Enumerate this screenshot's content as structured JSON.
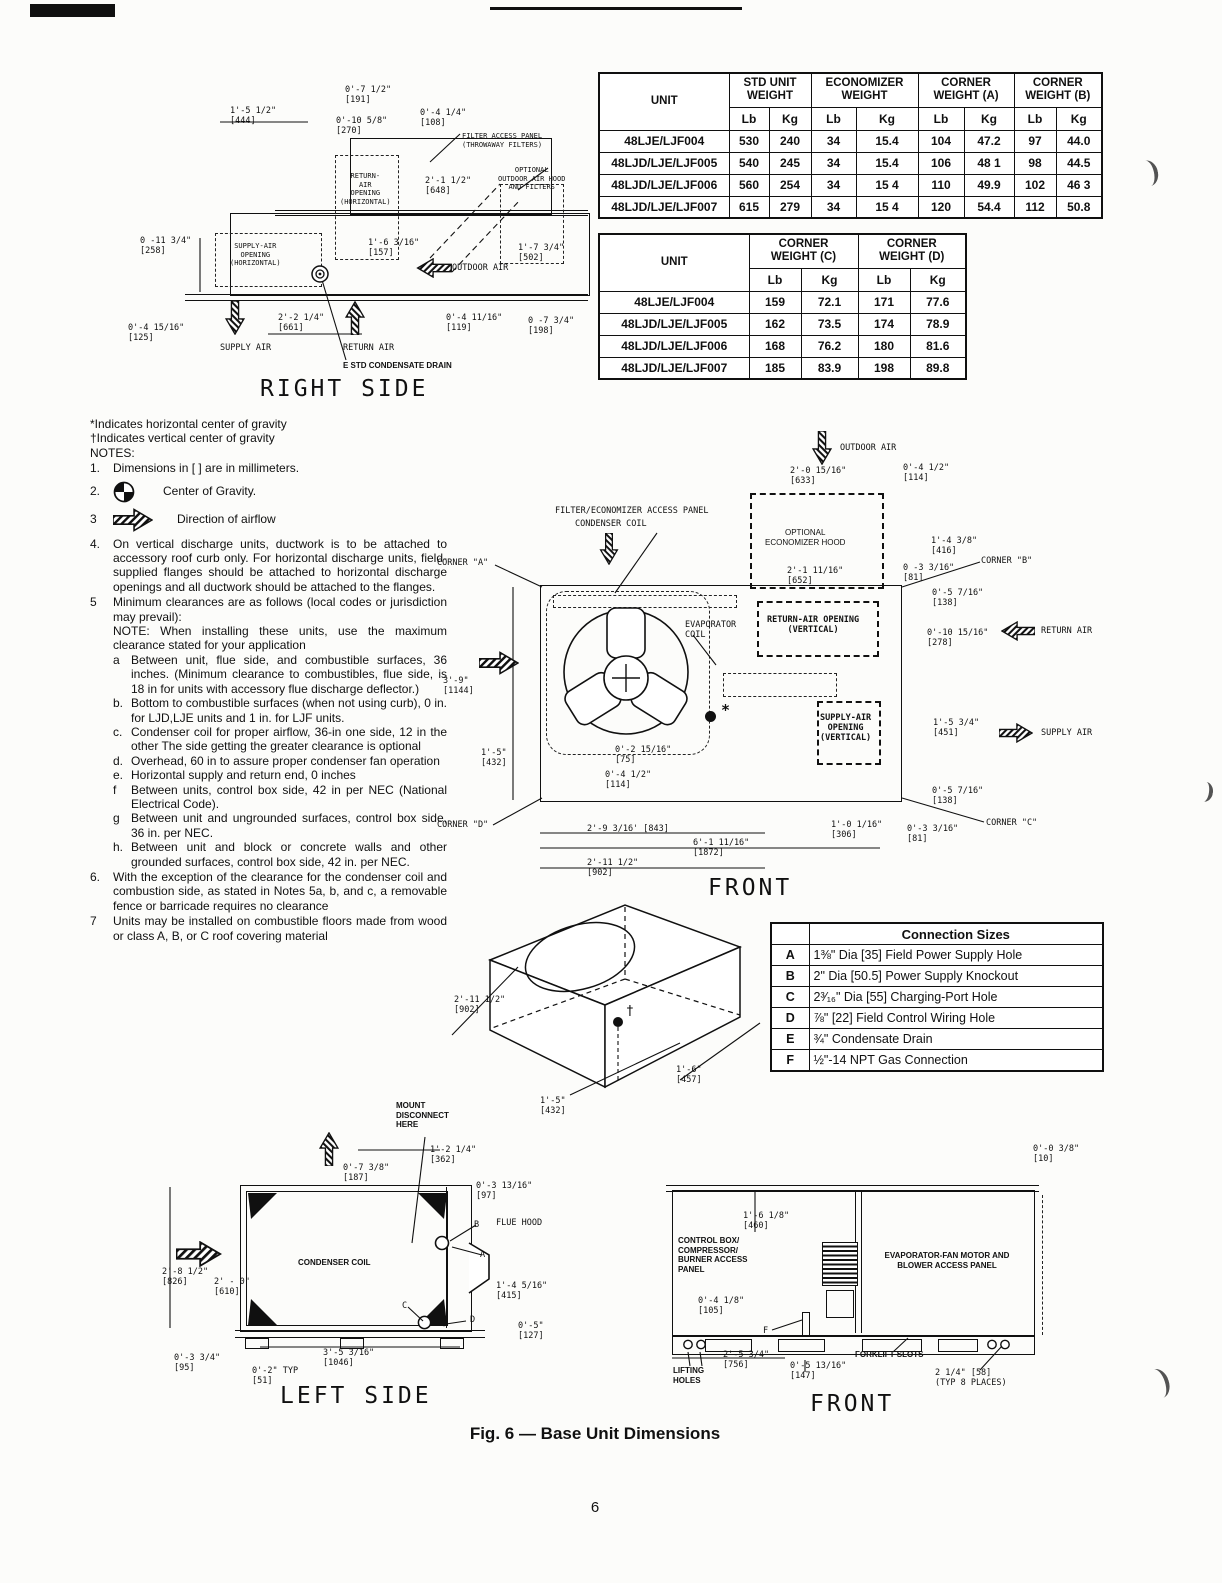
{
  "page": {
    "number": "6",
    "caption": "Fig. 6 — Base Unit Dimensions"
  },
  "weights_table": {
    "unit_header": "UNIT",
    "groups": [
      "STD UNIT\nWEIGHT",
      "ECONOMIZER\nWEIGHT",
      "CORNER\nWEIGHT (A)",
      "CORNER\nWEIGHT (B)"
    ],
    "sub": [
      "Lb",
      "Kg",
      "Lb",
      "Kg",
      "Lb",
      "Kg",
      "Lb",
      "Kg"
    ],
    "rows": [
      {
        "unit": "48LJE/LJF004",
        "values": [
          "530",
          "240",
          "34",
          "15.4",
          "104",
          "47.2",
          "97",
          "44.0"
        ]
      },
      {
        "unit": "48LJD/LJE/LJF005",
        "values": [
          "540",
          "245",
          "34",
          "15.4",
          "106",
          "48 1",
          "98",
          "44.5"
        ]
      },
      {
        "unit": "48LJD/LJE/LJF006",
        "values": [
          "560",
          "254",
          "34",
          "15 4",
          "110",
          "49.9",
          "102",
          "46 3"
        ]
      },
      {
        "unit": "48LJD/LJE/LJF007",
        "values": [
          "615",
          "279",
          "34",
          "15 4",
          "120",
          "54.4",
          "112",
          "50.8"
        ]
      }
    ]
  },
  "corner_table": {
    "unit_header": "UNIT",
    "groups": [
      "CORNER\nWEIGHT (C)",
      "CORNER\nWEIGHT (D)"
    ],
    "sub": [
      "Lb",
      "Kg",
      "Lb",
      "Kg"
    ],
    "rows": [
      {
        "unit": "48LJE/LJF004",
        "values": [
          "159",
          "72.1",
          "171",
          "77.6"
        ]
      },
      {
        "unit": "48LJD/LJE/LJF005",
        "values": [
          "162",
          "73.5",
          "174",
          "78.9"
        ]
      },
      {
        "unit": "48LJD/LJE/LJF006",
        "values": [
          "168",
          "76.2",
          "180",
          "81.6"
        ]
      },
      {
        "unit": "48LJD/LJE/LJF007",
        "values": [
          "185",
          "83.9",
          "198",
          "89.8"
        ]
      }
    ]
  },
  "connection_table": {
    "title": "Connection Sizes",
    "rows": [
      {
        "key": "A",
        "desc": "1⅜\" Dia [35] Field Power Supply Hole"
      },
      {
        "key": "B",
        "desc": "2\" Dia [50.5] Power Supply Knockout"
      },
      {
        "key": "C",
        "desc": "2³⁄₁₆\" Dia [55] Charging-Port Hole"
      },
      {
        "key": "D",
        "desc": "⅞\" [22] Field Control Wiring Hole"
      },
      {
        "key": "E",
        "desc": "¾\" Condensate Drain"
      },
      {
        "key": "F",
        "desc": "½\"-14 NPT Gas Connection"
      }
    ]
  },
  "notes": {
    "pre1": "*Indicates horizontal center of gravity",
    "pre2": "†Indicates vertical center of gravity",
    "heading": "NOTES:",
    "items": [
      {
        "m": "1.",
        "t": "Dimensions in [   ] are in millimeters."
      },
      {
        "m": "2.",
        "t": "Center of Gravity."
      },
      {
        "m": "3",
        "t": "Direction of airflow"
      },
      {
        "m": "4.",
        "t": "On vertical discharge units, ductwork is to be attached to accessory roof curb only. For horizontal discharge units, field-supplied flanges should be attached to horizontal discharge openings and all ductwork should be attached to the flanges."
      },
      {
        "m": "5",
        "t": "Minimum clearances are as follows (local codes or jurisdiction may prevail):\nNOTE: When installing these units, use the maximum clearance stated for your application"
      }
    ],
    "sub_items": [
      {
        "m": "a",
        "t": "Between unit, flue side, and combustible surfaces, 36 inches. (Minimum clearance to combustibles, flue side, is 18 in for units with accessory flue discharge deflector.)"
      },
      {
        "m": "b.",
        "t": "Bottom to combustible surfaces (when not using curb), 0 in. for LJD,LJE units and 1 in. for LJF units."
      },
      {
        "m": "c.",
        "t": "Condenser coil for proper airflow, 36-in one side, 12 in the other The side getting the greater clearance is optional"
      },
      {
        "m": "d.",
        "t": "Overhead, 60 in to assure proper condenser fan operation"
      },
      {
        "m": "e.",
        "t": "Horizontal supply and return end, 0 inches"
      },
      {
        "m": "f",
        "t": "Between units, control box side, 42 in per NEC (National Electrical Code)."
      },
      {
        "m": "g",
        "t": "Between unit and ungrounded surfaces, control box side, 36 in. per NEC."
      },
      {
        "m": "h.",
        "t": "Between unit and block or concrete walls and other grounded surfaces, control box side, 42 in. per NEC."
      }
    ],
    "items2": [
      {
        "m": "6.",
        "t": "With the exception of the clearance for the condenser coil and combustion side, as stated in Notes 5a, b, and c, a removable fence or barricade requires no clearance"
      },
      {
        "m": "7",
        "t": "Units may be installed on combustible floors made from wood or class A, B, or C roof covering material"
      }
    ]
  },
  "right_side": {
    "title": "RIGHT SIDE",
    "labels": [
      "0'-7 1/2\"\n[191]",
      "1'-5 1/2\"\n[444]",
      "0'-10 5/8\"\n[270]",
      "0'-4 1/4\"\n[108]",
      "FILTER ACCESS PANEL\n(THROWAWAY FILTERS)",
      "2'-1 1/2\"\n[648]",
      "OPTIONAL\nOUTDOOR AIR HOOD\nAND FILTERS",
      "RETURN-\nAIR\nOPENING\n(HORIZONTAL)",
      "0 -11 3/4\"\n[258]",
      "SUPPLY-AIR\nOPENING\n(HORIZONTAL)",
      "1'-6 3/16\"\n[157]",
      "OUTDOOR AIR",
      "1'-7 3/4\"\n[502]",
      "0'-4 15/16\"\n[125]",
      "SUPPLY AIR",
      "2'-2 1/4\"\n[661]",
      "RETURN AIR",
      "0'-4 11/16\"\n[119]",
      "0 -7 3/4\"\n[198]",
      "E STD CONDENSATE DRAIN"
    ]
  },
  "front_top": {
    "title": "FRONT",
    "labels": [
      "OUTDOOR AIR",
      "2'-0 15/16\"\n[633]",
      "0'-4 1/2\"\n[114]",
      "FILTER/ECONOMIZER ACCESS PANEL",
      "CONDENSER COIL",
      "OPTIONAL\nECONOMIZER HOOD",
      "1'-4 3/8\"\n[416]",
      "2'-1 11/16\"\n[652]",
      "0 -3 3/16\"\n[81]",
      "CORNER \"B\"",
      "0'-5 7/16\"\n[138]",
      "EVAPORATOR\nCOIL",
      "RETURN-AIR OPENING\n(VERTICAL)",
      "0'-10 15/16\"\n[278]",
      "RETURN AIR",
      "3'-9\"\n[1144]",
      "SUPPLY-AIR\nOPENING\n(VERTICAL)",
      "1'-5 3/4\"\n[451]",
      "SUPPLY AIR",
      "1'-5\"\n[432]",
      "0'-2 15/16\"\n[75]",
      "0'-4 1/2\"\n[114]",
      "0'-5 7/16\"\n[138]",
      "CORNER \"D\"",
      "2'-9 3/16' [843]",
      "1'-0 1/16\"\n[306]",
      "0'-3 3/16\"\n[81]",
      "CORNER \"C\"",
      "6'-1 11/16\"\n[1872]",
      "2'-11 1/2\"\n[902]",
      "*",
      "CORNER \"A\""
    ]
  },
  "isometric": {
    "labels": [
      "2'-11 1/2\"\n[902]",
      "1'-5\"\n[432]",
      "1'-6\"\n[457]",
      "†"
    ]
  },
  "left_side": {
    "title": "LEFT SIDE",
    "labels": [
      "MOUNT\nDISCONNECT\nHERE",
      "1'-2 1/4\"\n[362]",
      "0'-7 3/8\"\n[187]",
      "0'-3 13/16\"\n[97]",
      "B",
      "FLUE HOOD",
      "A",
      "CONDENSER COIL",
      "2'-8 1/2\"\n[826]",
      "2' - 0\"\n[610]",
      "1'-4 5/16\"\n[415]",
      "C",
      "D",
      "0'-5\"\n[127]",
      "0'-3 3/4\"\n[95]",
      "3'-5 3/16\"\n[1046]",
      "0'-2\" TYP\n[51]"
    ]
  },
  "front_bottom": {
    "title": "FRONT",
    "labels": [
      "0'-0 3/8\"\n[10]",
      "1'-6 1/8\"\n[460]",
      "CONTROL BOX/\nCOMPRESSOR/\nBURNER ACCESS\nPANEL",
      "EVAPORATOR-FAN MOTOR AND\nBLOWER ACCESS PANEL",
      "0'-4 1/8\"\n[105]",
      "F",
      "2'-5 3/4\"\n[756]",
      "0'-5 13/16\"\n[147]",
      "FORKLIFT SLOTS",
      "LIFTING\nHOLES",
      "2 1/4\" [58]\n(TYP 8 PLACES)"
    ]
  }
}
